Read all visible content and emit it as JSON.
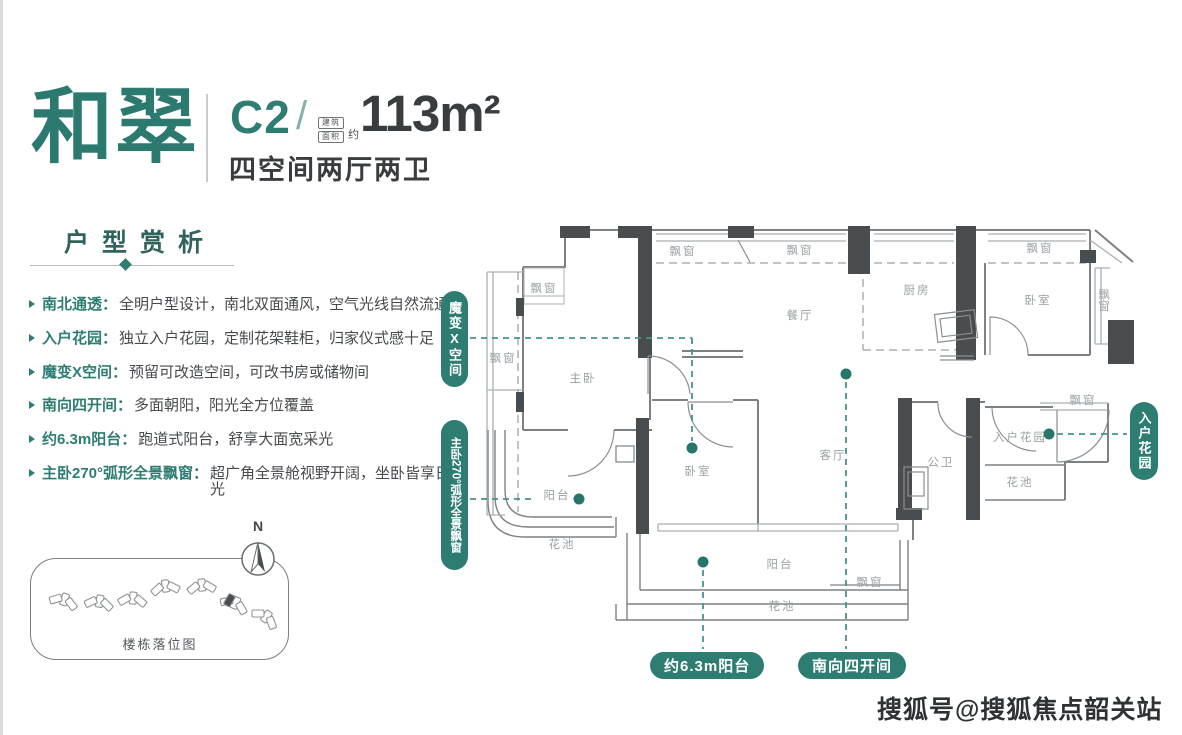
{
  "brand": {
    "name": "和翠"
  },
  "unit": {
    "code": "C2",
    "slash": "/",
    "area_badge_line1": "建筑",
    "area_badge_line2": "面积",
    "area_approx": "约",
    "area": "113m²",
    "layout": "四空间两厅两卫"
  },
  "section": {
    "title": "户型赏析"
  },
  "features": [
    {
      "term": "南北通透：",
      "desc": "全明户型设计，南北双面通风，空气光线自然流通"
    },
    {
      "term": "入户花园：",
      "desc": "独立入户花园，定制花架鞋柜，归家仪式感十足"
    },
    {
      "term": "魔变X空间：",
      "desc": "预留可改造空间，可改书房或储物间"
    },
    {
      "term": "南向四开间：",
      "desc": "多面朝阳，阳光全方位覆盖"
    },
    {
      "term": "约6.3m阳台：",
      "desc": "跑道式阳台，舒享大面宽采光"
    },
    {
      "term": "主卧270°弧形全景飘窗：",
      "desc": "超广角全景舱视野开阔，坐卧皆享日光"
    }
  ],
  "sitemap": {
    "caption": "楼栋落位图",
    "compass_label": "N"
  },
  "plan": {
    "labels": [
      "主卧",
      "餐厅",
      "厨房",
      "卧室",
      "卧室",
      "客厅",
      "公卫",
      "入户花园",
      "阳台",
      "阳台",
      "花池",
      "花池",
      "花池",
      "飘窗",
      "飘窗",
      "飘窗",
      "飘窗",
      "飘窗",
      "飘窗",
      "飘窗",
      "飘窗"
    ],
    "callouts": {
      "magic": "魔变X空间",
      "bay270": "主卧270°弧形全景飘窗",
      "garden": "入户花园",
      "balcony63": "约6.3m阳台",
      "south4": "南向四开间"
    }
  },
  "watermark": "搜狐号@搜狐焦点韶关站",
  "colors": {
    "teal": "#2e7d72",
    "teal_dash": "#44948a",
    "dark_text": "#393d40",
    "wall_dark": "#4a4d4f",
    "wall_line": "#7d8184",
    "label_gray": "#9aa0a3"
  }
}
